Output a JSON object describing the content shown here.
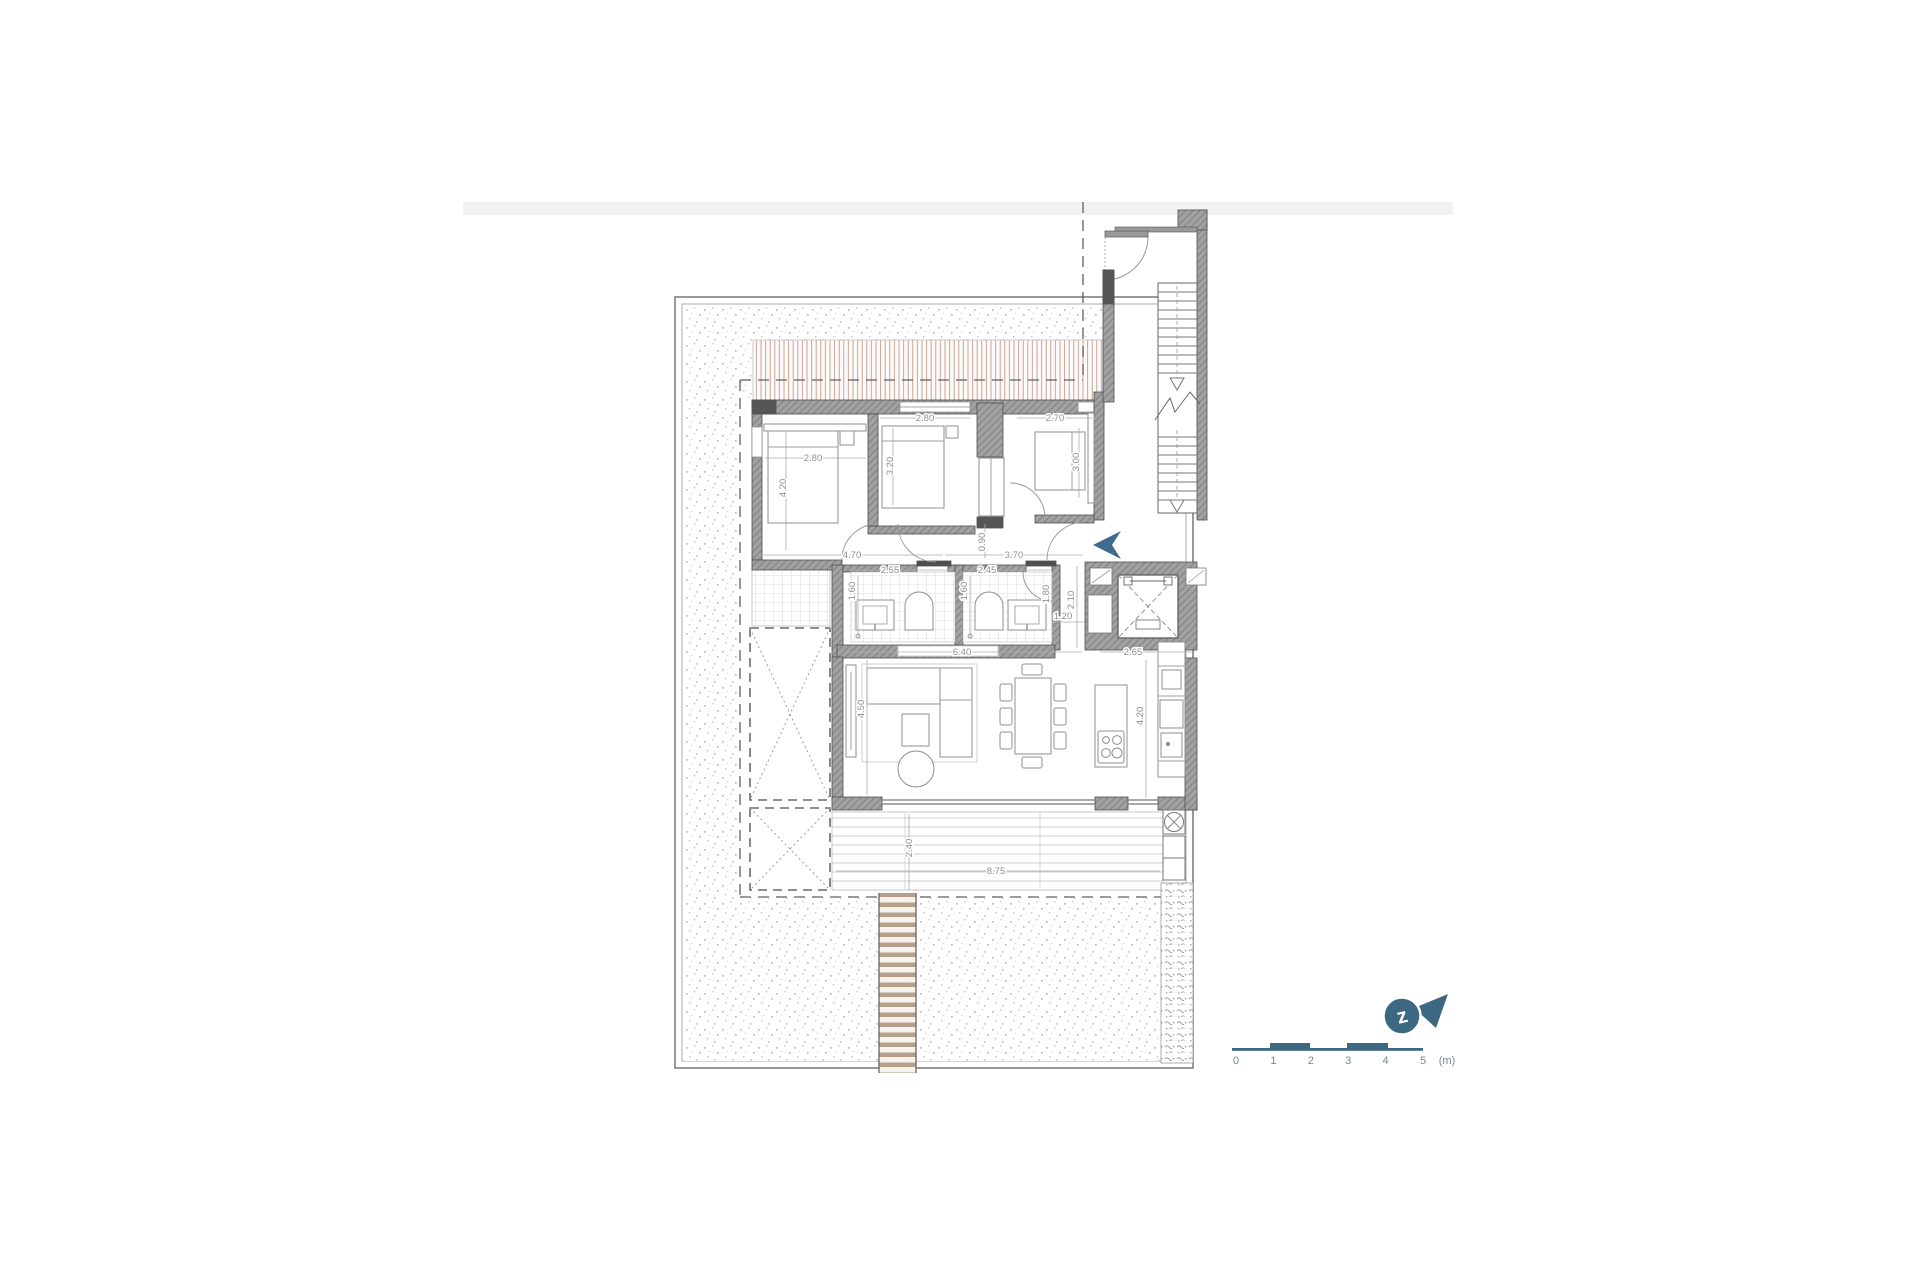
{
  "document": {
    "type": "architectural-floor-plan",
    "background": "#ffffff",
    "top_strip_color": "#f1f1f1"
  },
  "colors": {
    "accent_blue": "#3c6882",
    "entry_arrow_blue": "#3f6b8e",
    "wall_gray": "#9f9f9f",
    "wall_dark": "#4f4f4f",
    "line_gray": "#8a8a8a",
    "dim_text_gray": "#8f8f8f",
    "canopy_brown": "#b58b77",
    "deck_walk_brown": "#b5a08b"
  },
  "floor_plan": {
    "dimensions": [
      {
        "text": "2.80",
        "x": 813,
        "y": 461,
        "rot": 0
      },
      {
        "text": "4.20",
        "x": 786,
        "y": 488,
        "rot": -90
      },
      {
        "text": "2.80",
        "x": 925,
        "y": 421,
        "rot": 0
      },
      {
        "text": "3.20",
        "x": 893,
        "y": 466,
        "rot": -90
      },
      {
        "text": "2.70",
        "x": 1055,
        "y": 421,
        "rot": 0
      },
      {
        "text": "3.00",
        "x": 1079,
        "y": 462,
        "rot": -90
      },
      {
        "text": "0.90",
        "x": 985,
        "y": 542,
        "rot": -90
      },
      {
        "text": "4.70",
        "x": 852,
        "y": 558,
        "rot": 0
      },
      {
        "text": "3.70",
        "x": 1014,
        "y": 558,
        "rot": 0
      },
      {
        "text": "2.55",
        "x": 890,
        "y": 573,
        "rot": 0
      },
      {
        "text": "1.60",
        "x": 855,
        "y": 591,
        "rot": -90
      },
      {
        "text": "2.45",
        "x": 987,
        "y": 573,
        "rot": 0
      },
      {
        "text": "1.60",
        "x": 967,
        "y": 591,
        "rot": -90
      },
      {
        "text": "1.80",
        "x": 1049,
        "y": 594,
        "rot": -90
      },
      {
        "text": "1.20",
        "x": 1063,
        "y": 619,
        "rot": 0
      },
      {
        "text": "2.10",
        "x": 1074,
        "y": 600,
        "rot": -90
      },
      {
        "text": "6.40",
        "x": 962,
        "y": 655,
        "rot": 0
      },
      {
        "text": "2.65",
        "x": 1133,
        "y": 655,
        "rot": 0
      },
      {
        "text": "4.50",
        "x": 864,
        "y": 709,
        "rot": -90
      },
      {
        "text": "4.20",
        "x": 1143,
        "y": 716,
        "rot": -90
      },
      {
        "text": "2.40",
        "x": 912,
        "y": 848,
        "rot": -90
      },
      {
        "text": "8.75",
        "x": 996,
        "y": 874,
        "rot": 0
      }
    ]
  },
  "scale_bar": {
    "ticks": [
      "0",
      "1",
      "2",
      "3",
      "4",
      "5"
    ],
    "unit": "(m)"
  },
  "north_arrow": {
    "letter": "z"
  }
}
